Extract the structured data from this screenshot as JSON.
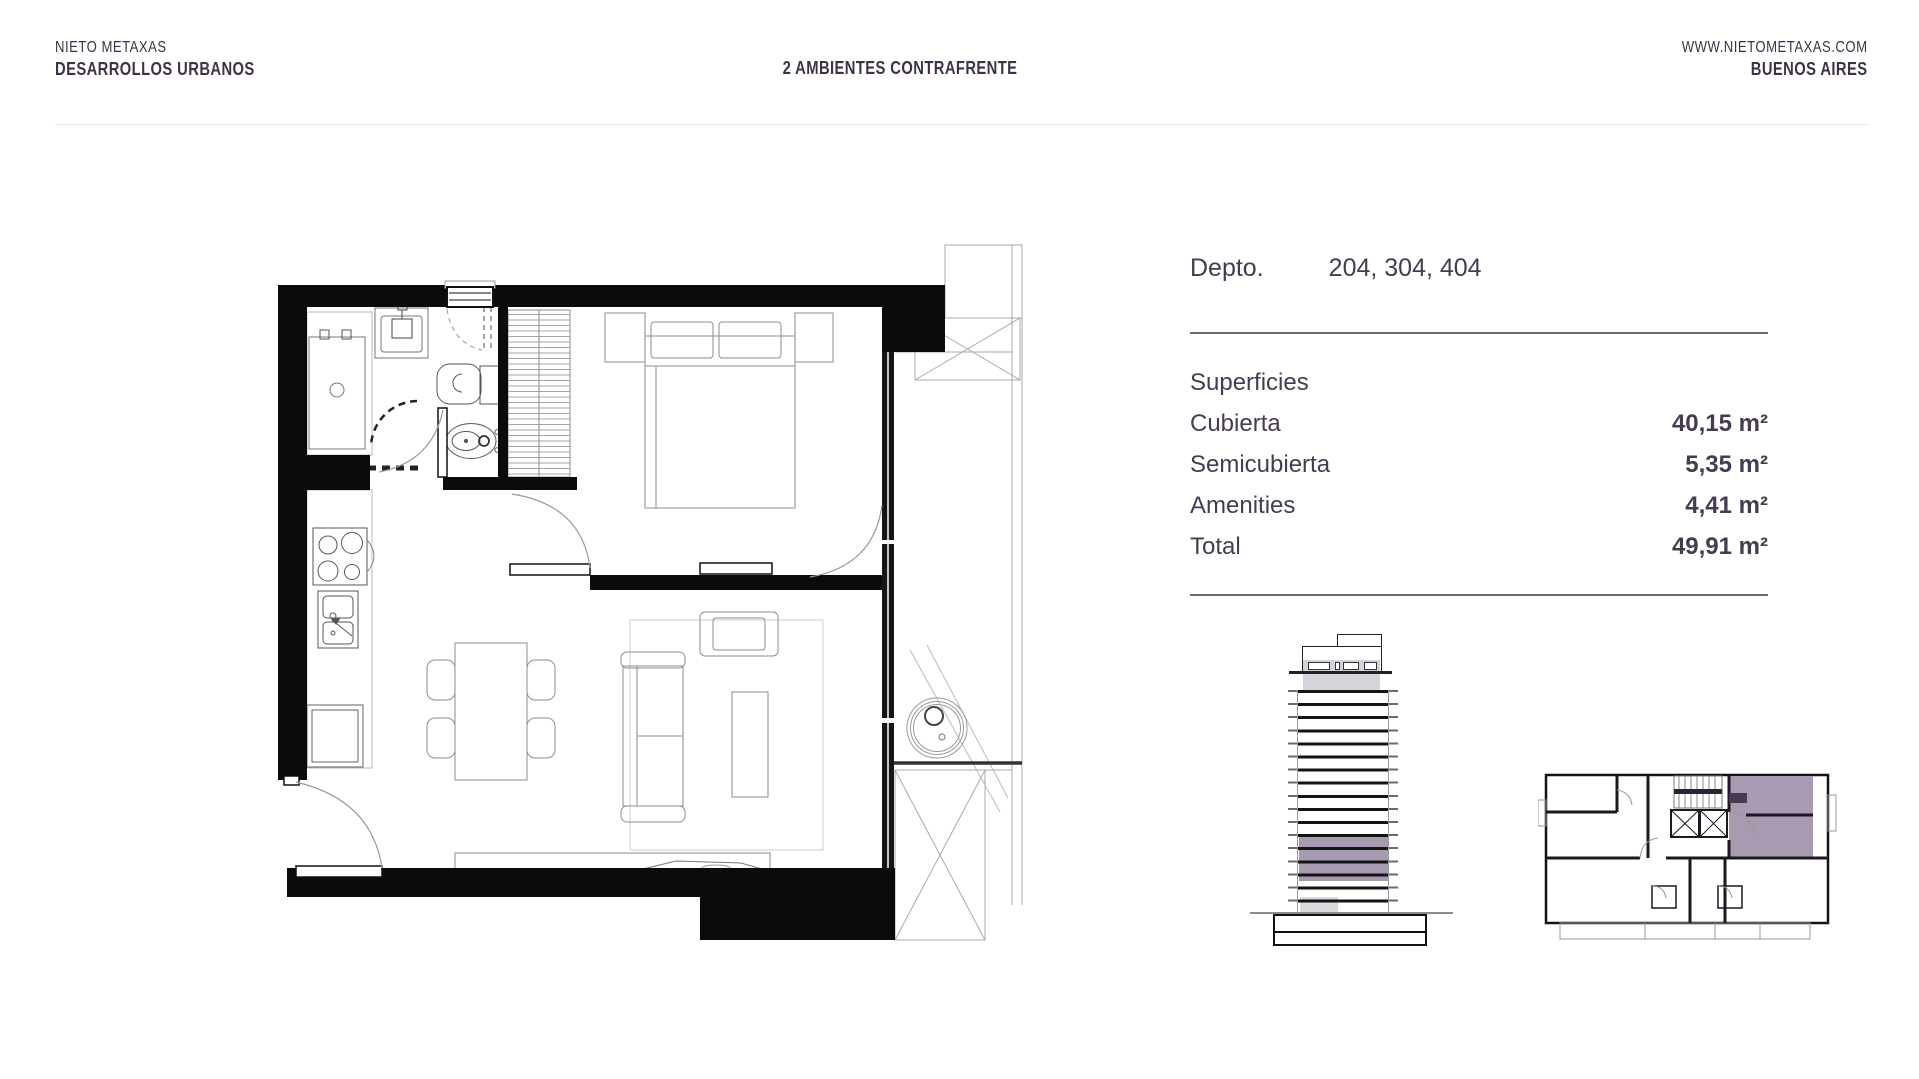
{
  "header": {
    "brand_line1": "NIETO METAXAS",
    "brand_line2": "DESARROLLOS URBANOS",
    "title": "2 AMBIENTES CONTRAFRENTE",
    "website": "WWW.NIETOMETAXAS.COM",
    "city": "BUENOS AIRES"
  },
  "unit_info": {
    "depto_label": "Depto.",
    "depto_numbers": "204, 304, 404",
    "sections_title": "Superficies",
    "rows": [
      {
        "label": "Cubierta",
        "value": "40,15 m²"
      },
      {
        "label": "Semicubierta",
        "value": "5,35 m²"
      },
      {
        "label": "Amenities",
        "value": "4,41 m²"
      },
      {
        "label": "Total",
        "value": "49,91 m²"
      }
    ]
  },
  "colors": {
    "header_text": "#3E3148",
    "panel_text": "#453C4F",
    "panel_rule": "#6F6878",
    "highlight_mauve": "#A89AB1",
    "drawing_black": "#111111",
    "drawing_gray": "#8E8E8E",
    "header_rule": "#E8E6EC"
  }
}
